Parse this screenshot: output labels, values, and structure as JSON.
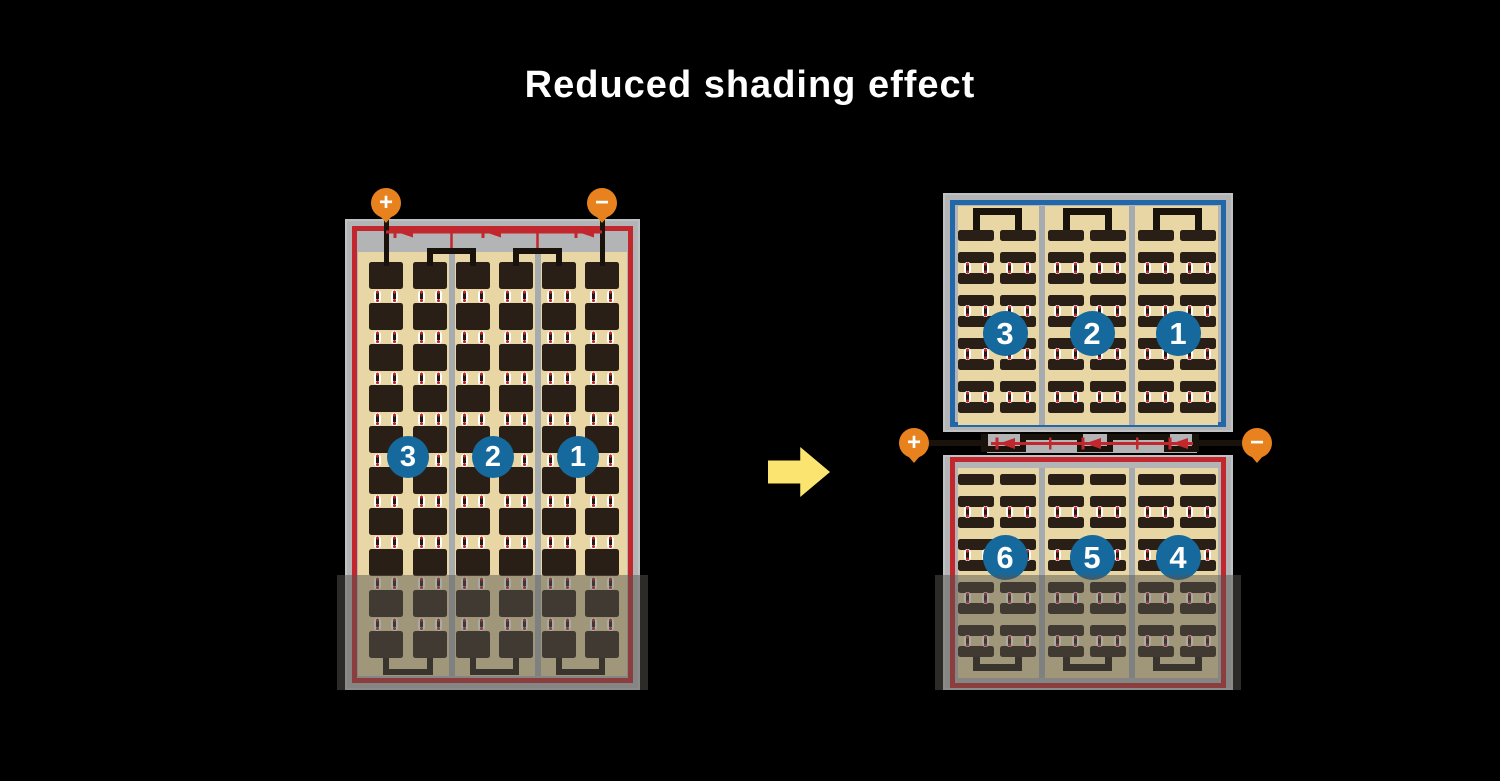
{
  "title": "Reduced shading effect",
  "colors": {
    "terminal_orange": "#e8821e",
    "badge_blue": "#15699c",
    "circuit_red": "#c1272d",
    "circuit_blue": "#2268a8",
    "cell_dark": "#2a1f16",
    "panel_tan": "#e8d7a4",
    "frame_gray": "#b3b4b6",
    "arrow_yellow": "#fbe470"
  },
  "left_module": {
    "terminal_positive": "+",
    "terminal_negative": "−",
    "cell_groups": [
      "3",
      "2",
      "1"
    ]
  },
  "split_module": {
    "terminal_positive": "+",
    "terminal_negative": "−",
    "top_groups": [
      "3",
      "2",
      "1"
    ],
    "bottom_groups": [
      "6",
      "5",
      "4"
    ]
  }
}
